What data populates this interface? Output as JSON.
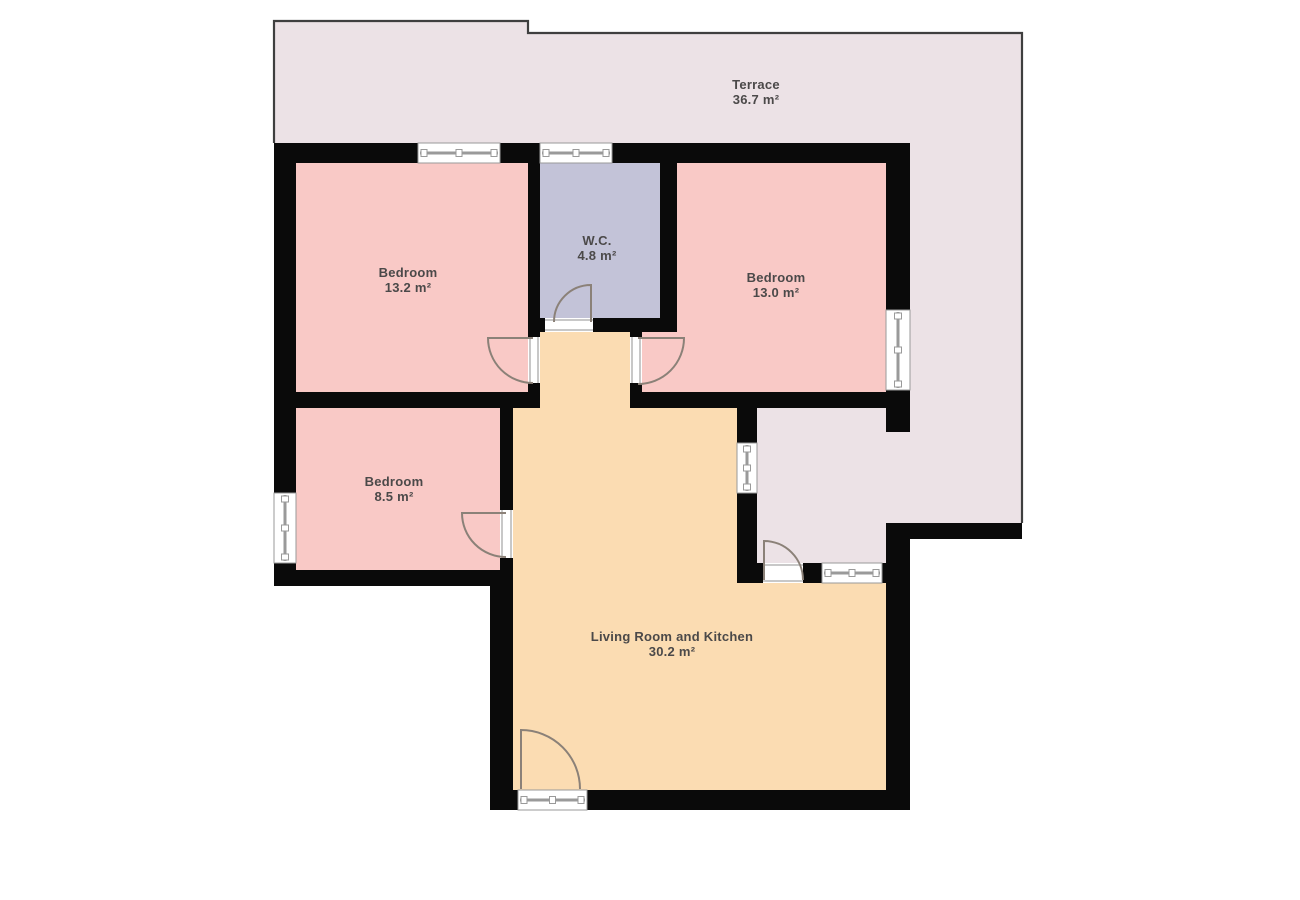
{
  "canvas": {
    "width": 1300,
    "height": 900,
    "background": "#ffffff"
  },
  "colors": {
    "wall": "#0a0a0a",
    "terrace_fill": "#ece2e6",
    "bedroom_fill": "#f9c9c6",
    "wc_fill": "#c3c3d8",
    "living_fill": "#fbdcb2",
    "outline": "#3f3f3f",
    "door": "#8b8178",
    "window_line": "#9a9a9a",
    "threshold_line": "#b5b5b5",
    "text": "#4b4949"
  },
  "floorplan": {
    "rooms": [
      {
        "id": "terrace",
        "name": "Terrace",
        "area": "36.7 m²",
        "fill_key": "terrace_fill",
        "label": {
          "x": 756,
          "y": 89
        },
        "rects": [
          [
            274,
            21,
            254,
            122
          ],
          [
            528,
            33,
            494,
            110
          ],
          [
            910,
            143,
            112,
            380
          ],
          [
            757,
            408,
            131,
            155
          ],
          [
            888,
            432,
            22,
            91
          ]
        ]
      },
      {
        "id": "bedroom-1",
        "name": "Bedroom",
        "area": "13.2 m²",
        "fill_key": "bedroom_fill",
        "label": {
          "x": 408,
          "y": 277
        },
        "rects": [
          [
            296,
            163,
            232,
            229
          ]
        ]
      },
      {
        "id": "wc",
        "name": "W.C.",
        "area": "4.8 m²",
        "fill_key": "wc_fill",
        "label": {
          "x": 597,
          "y": 245
        },
        "rects": [
          [
            540,
            163,
            120,
            155
          ]
        ]
      },
      {
        "id": "bedroom-2",
        "name": "Bedroom",
        "area": "13.0 m²",
        "fill_key": "bedroom_fill",
        "label": {
          "x": 776,
          "y": 282
        },
        "rects": [
          [
            677,
            163,
            211,
            229
          ],
          [
            642,
            332,
            35,
            60
          ]
        ]
      },
      {
        "id": "bedroom-3",
        "name": "Bedroom",
        "area": "8.5 m²",
        "fill_key": "bedroom_fill",
        "label": {
          "x": 394,
          "y": 486
        },
        "rects": [
          [
            296,
            408,
            204,
            162
          ]
        ]
      },
      {
        "id": "living-room-kitchen",
        "name": "Living Room and Kitchen",
        "area": "30.2 m²",
        "fill_key": "living_fill",
        "label": {
          "x": 672,
          "y": 641
        },
        "rects": [
          [
            534,
            328,
            102,
            84
          ],
          [
            513,
            408,
            229,
            178
          ],
          [
            513,
            578,
            373,
            212
          ]
        ]
      }
    ],
    "terrace_outline": {
      "points": "274,143 274,21 528,21 528,33 1022,33 1022,523"
    },
    "walls": [
      [
        274,
        143,
        636,
        20
      ],
      [
        274,
        143,
        22,
        443
      ],
      [
        528,
        163,
        12,
        169
      ],
      [
        660,
        143,
        17,
        189
      ],
      [
        528,
        318,
        149,
        14
      ],
      [
        528,
        332,
        12,
        76
      ],
      [
        274,
        392,
        266,
        16
      ],
      [
        630,
        332,
        12,
        60
      ],
      [
        630,
        392,
        280,
        16
      ],
      [
        886,
        143,
        24,
        289
      ],
      [
        500,
        408,
        13,
        162
      ],
      [
        274,
        570,
        239,
        16
      ],
      [
        490,
        570,
        23,
        240
      ],
      [
        490,
        790,
        420,
        20
      ],
      [
        886,
        523,
        24,
        287
      ],
      [
        737,
        408,
        20,
        175
      ],
      [
        737,
        563,
        169,
        20
      ],
      [
        886,
        523,
        136,
        16
      ]
    ],
    "windows": [
      {
        "rect": [
          418,
          143,
          82,
          20
        ],
        "dir": "h"
      },
      {
        "rect": [
          540,
          143,
          72,
          20
        ],
        "dir": "h"
      },
      {
        "rect": [
          886,
          310,
          24,
          80
        ],
        "dir": "v"
      },
      {
        "rect": [
          274,
          493,
          22,
          70
        ],
        "dir": "v"
      },
      {
        "rect": [
          737,
          443,
          20,
          50
        ],
        "dir": "v"
      },
      {
        "rect": [
          822,
          563,
          60,
          20
        ],
        "dir": "h"
      },
      {
        "rect": [
          518,
          790,
          69,
          20
        ],
        "dir": "h"
      }
    ],
    "thresholds": [
      {
        "rect": [
          545,
          318,
          48,
          14
        ],
        "dir": "h"
      },
      {
        "rect": [
          528,
          337,
          12,
          46
        ],
        "dir": "v"
      },
      {
        "rect": [
          630,
          337,
          12,
          46
        ],
        "dir": "v"
      },
      {
        "rect": [
          500,
          510,
          13,
          48
        ],
        "dir": "v"
      },
      {
        "rect": [
          763,
          563,
          40,
          20
        ],
        "dir": "h"
      }
    ],
    "doors": [
      {
        "id": "wc-door",
        "hinge": [
          591,
          322
        ],
        "leaf": [
          591,
          285
        ],
        "end": [
          554,
          322
        ],
        "sweep": 0
      },
      {
        "id": "bedroom-1-door",
        "hinge": [
          533,
          338
        ],
        "leaf": [
          488,
          338
        ],
        "end": [
          533,
          383
        ],
        "sweep": 0
      },
      {
        "id": "bedroom-2-door",
        "hinge": [
          638,
          338
        ],
        "leaf": [
          684,
          338
        ],
        "end": [
          638,
          384
        ],
        "sweep": 1
      },
      {
        "id": "bedroom-3-door",
        "hinge": [
          506,
          513
        ],
        "leaf": [
          462,
          513
        ],
        "end": [
          506,
          557
        ],
        "sweep": 0
      },
      {
        "id": "living-room-door",
        "hinge": [
          521,
          789
        ],
        "leaf": [
          521,
          730
        ],
        "end": [
          580,
          789
        ],
        "sweep": 1
      },
      {
        "id": "entrance-door",
        "hinge": [
          764,
          580
        ],
        "leaf": [
          764,
          541
        ],
        "end": [
          803,
          580
        ],
        "sweep": 1
      }
    ]
  }
}
